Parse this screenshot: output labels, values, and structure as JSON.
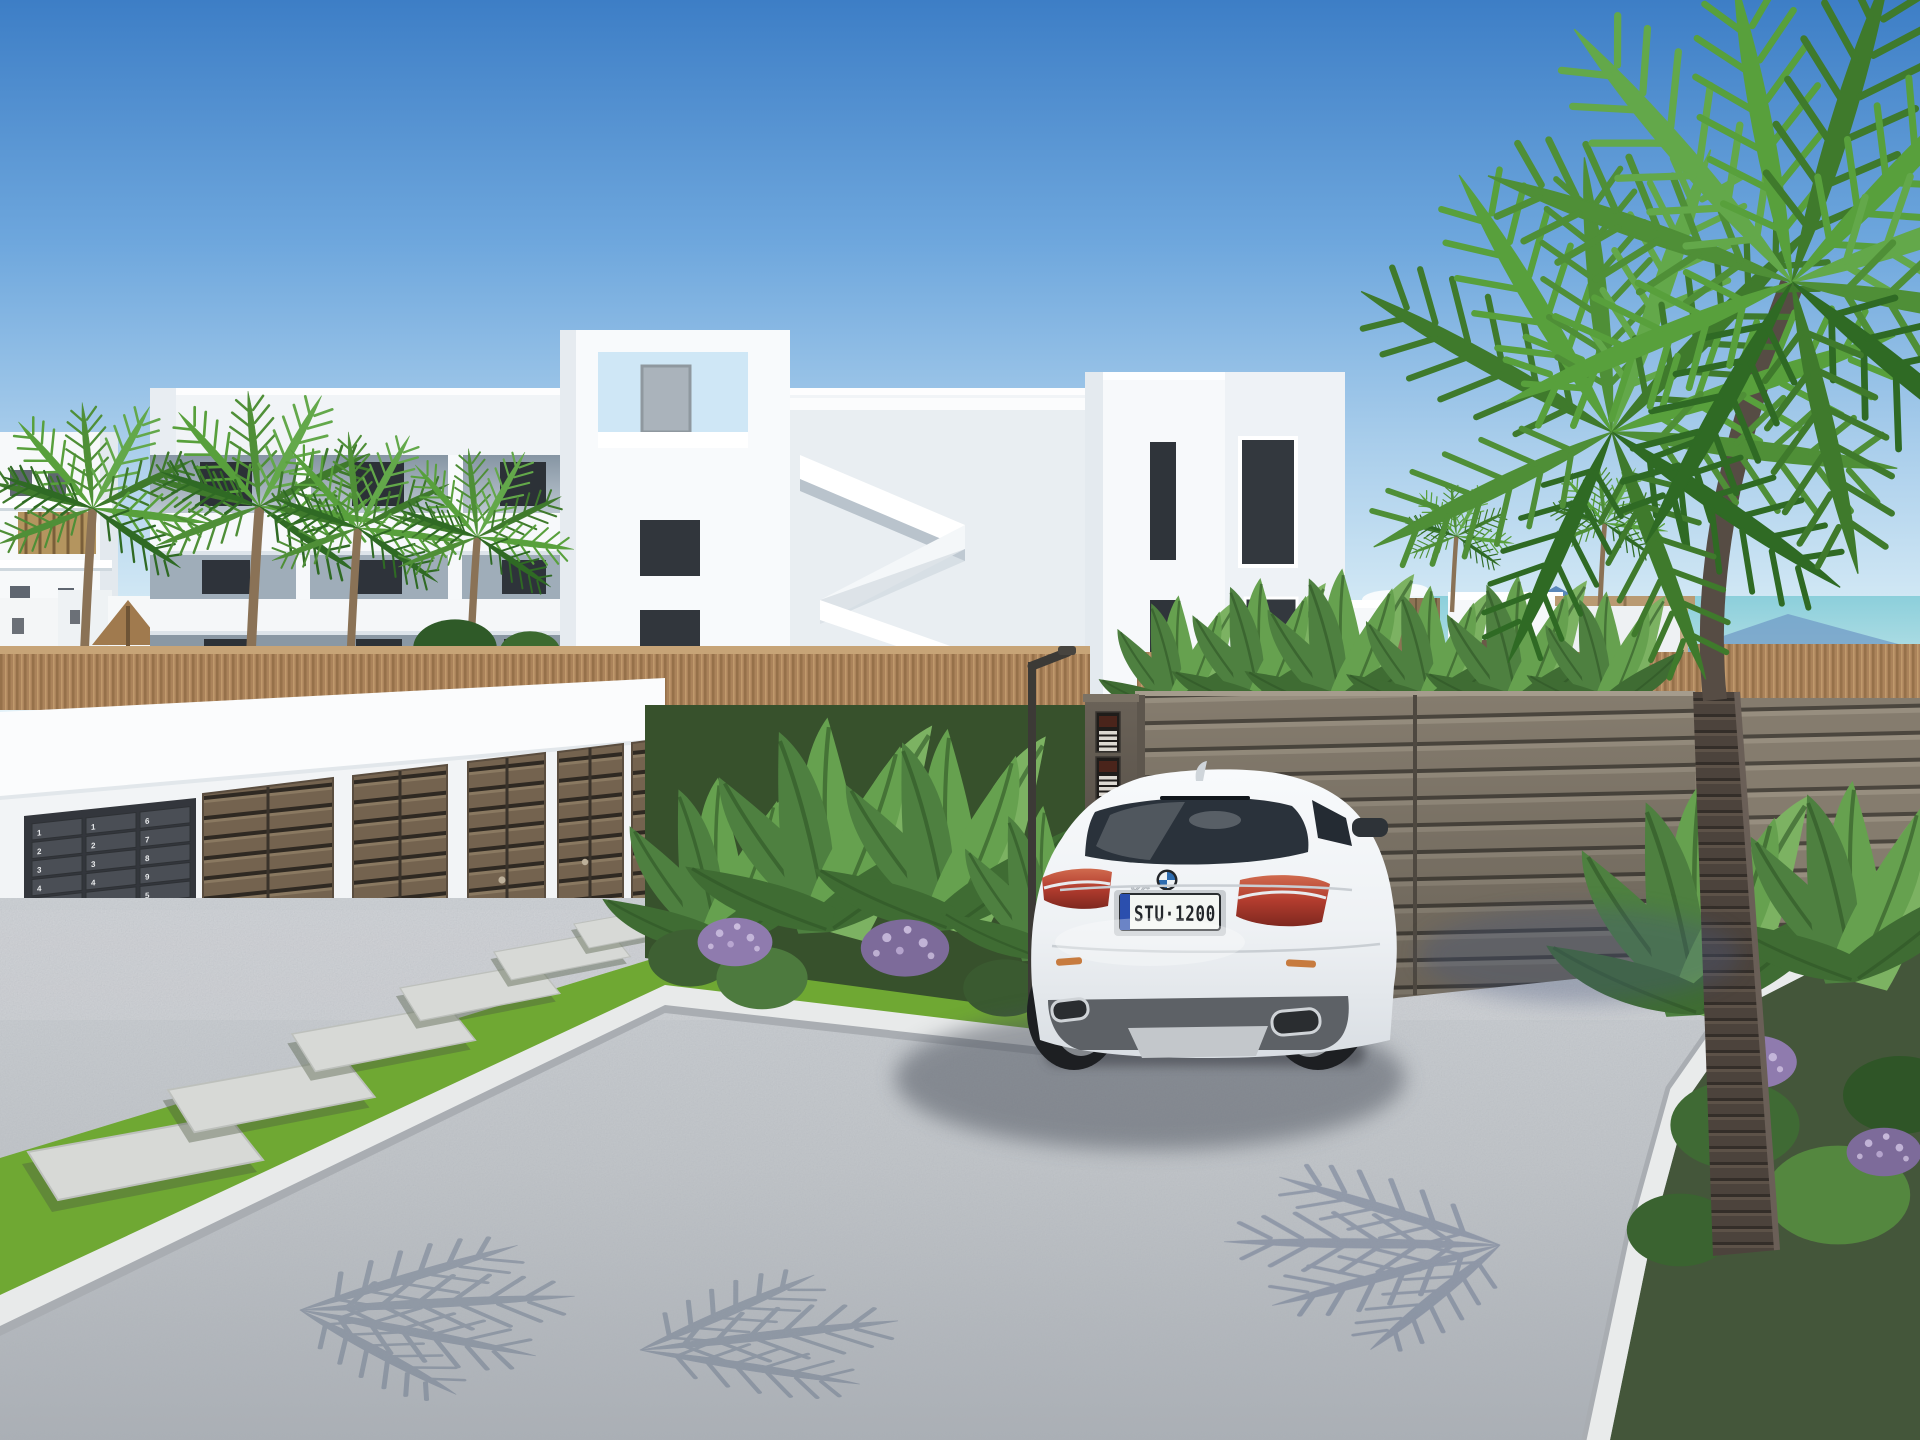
{
  "car": {
    "license_plate": "STU·1200",
    "model_badge": "X6",
    "brand_icon": "bmw-roundel-icon",
    "body_color": "#f3f5f7",
    "plate_band_color": "#2b4fae"
  },
  "background_car": {
    "body_color": "#b9bec3"
  },
  "mailboxes": {
    "panel_color": "#4a4e55",
    "digit_color": "#e8eaec",
    "columns": [
      [
        "1",
        "2",
        "3",
        "4",
        "5",
        "1",
        "2",
        "3",
        "4",
        "5",
        "1",
        "2"
      ],
      [
        "1",
        "2",
        "3",
        "4",
        "5",
        "1",
        "2",
        "3",
        "4",
        "5",
        "1",
        "2"
      ],
      [
        "6",
        "7",
        "8",
        "9",
        "5",
        "6",
        "7",
        "8",
        "9",
        "5",
        "1",
        "2"
      ]
    ]
  },
  "palette": {
    "sky_top": "#3d7ec6",
    "sky_horizon": "#eaf5fa",
    "building_white": "#f6f8fa",
    "reed_fence": "#ab835b",
    "door_brown": "#74634f",
    "gate_taupe": "#857c6e",
    "driveway_gray": "#bfc3c7",
    "grass_green": "#6fa833",
    "palm_green": "#4f8f37",
    "mountain_blue": "#4f7fb4",
    "sea_teal": "#8ccfdb",
    "flower_purple": "#8f7bae"
  }
}
